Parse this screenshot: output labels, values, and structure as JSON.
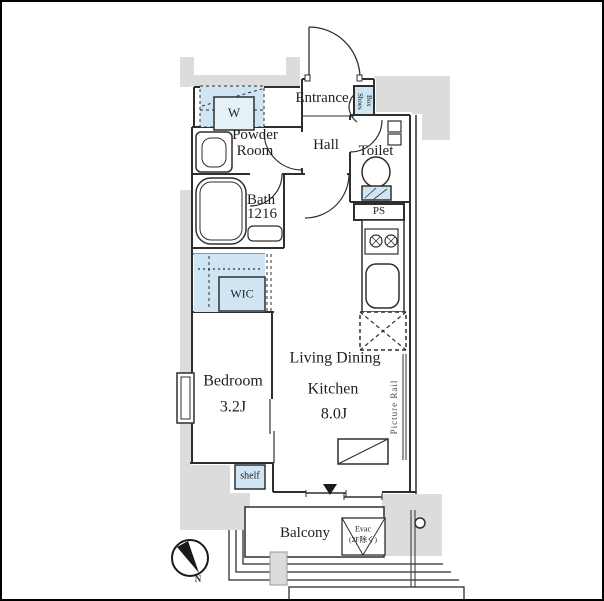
{
  "floorplan": {
    "labels": {
      "entrance": "Entrance",
      "shoes_box": "Shoes Box",
      "powder_room": "Powder Room",
      "hall": "Hall",
      "toilet": "Toilet",
      "bath": "Bath",
      "bath_size": "1216",
      "ps": "PS",
      "washer": "W",
      "wic": "WIC",
      "bedroom": "Bedroom",
      "bedroom_size": "3.2J",
      "ldk_line1": "Living Dining",
      "ldk_line2": "Kitchen",
      "ldk_size": "8.0J",
      "picture_rail": "Picture Rail",
      "shelf": "shelf",
      "balcony": "Balcony",
      "evac_line1": "Evac",
      "evac_line2": "(2F除く)",
      "compass_north": "N"
    },
    "colors": {
      "fixture_blue": "#cfe5f3",
      "fixture_blue_light": "#e4f1f9",
      "structure_gray": "#dcdcdc",
      "line_dark": "#2e2e2e"
    }
  }
}
